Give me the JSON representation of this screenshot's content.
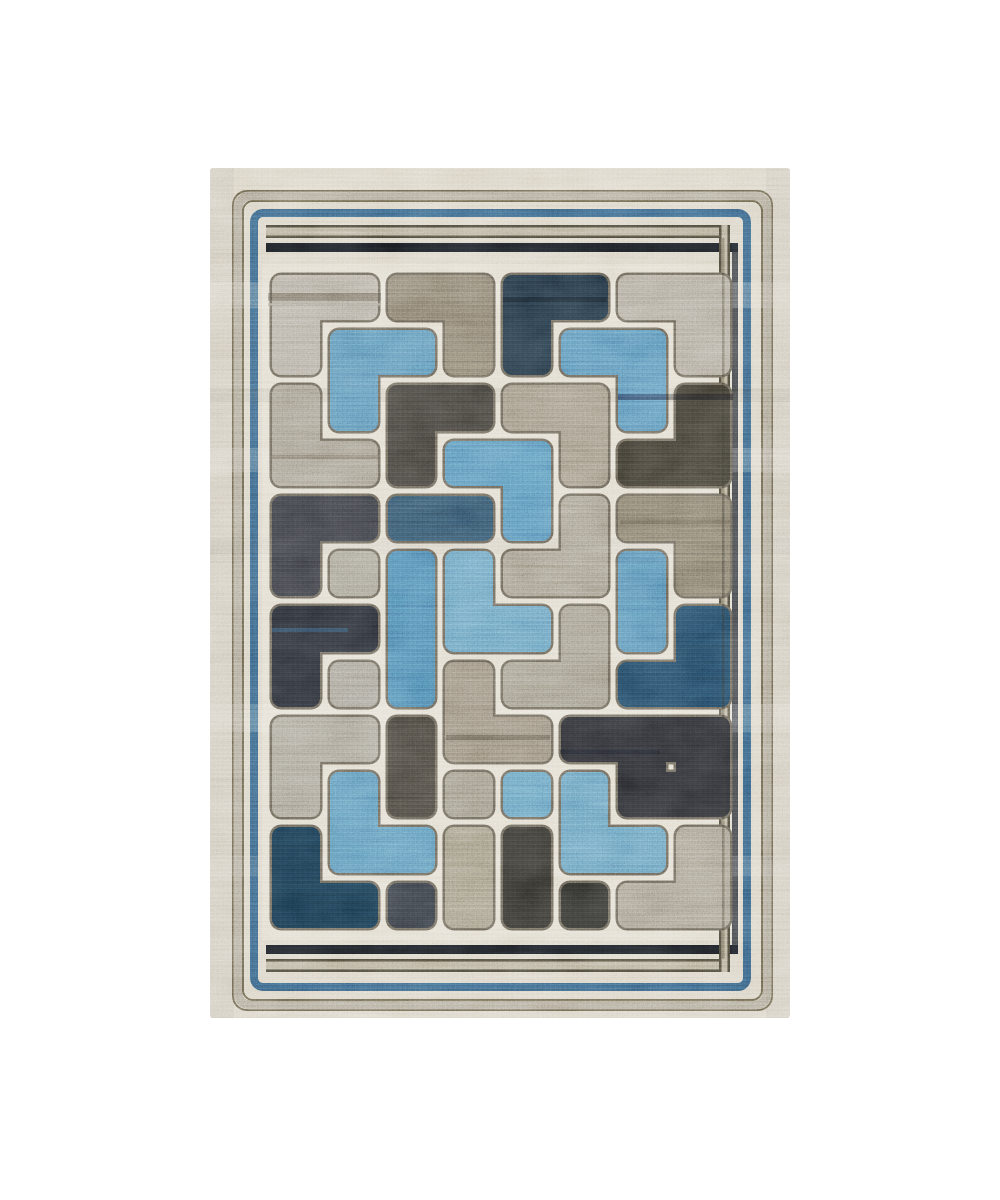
{
  "scene": {
    "width": 1000,
    "height": 1200,
    "background": "#ffffff"
  },
  "rug": {
    "x": 210,
    "y": 168,
    "width": 580,
    "height": 850,
    "base_color": "#cfc7b5",
    "field_bg": {
      "x": 262,
      "y": 264,
      "width": 478,
      "height": 676,
      "color": "#d8d1c0"
    },
    "frame_rects": [
      {
        "x": 233,
        "y": 191,
        "w": 539,
        "h": 819,
        "r": 14,
        "stroke": "#57513f",
        "sw": 2
      },
      {
        "x": 238,
        "y": 196,
        "w": 529,
        "h": 809,
        "r": 12,
        "stroke": "#9a917e",
        "sw": 9
      },
      {
        "x": 243,
        "y": 201,
        "w": 519,
        "h": 799,
        "r": 10,
        "stroke": "#57513f",
        "sw": 2
      },
      {
        "x": 254,
        "y": 213,
        "w": 493,
        "h": 774,
        "r": 9,
        "stroke": "#2e4f6a",
        "sw": 8
      }
    ],
    "stripes": [
      {
        "x": 266,
        "y": 225,
        "w": 464,
        "h": 13,
        "fill": "#a1977e",
        "opacity": 1
      },
      {
        "x": 266,
        "y": 225,
        "w": 464,
        "h": 2.5,
        "fill": "#3b382c",
        "opacity": 1
      },
      {
        "x": 266,
        "y": 235.5,
        "w": 464,
        "h": 2.5,
        "fill": "#3b382c",
        "opacity": 1
      },
      {
        "x": 266,
        "y": 243,
        "w": 472,
        "h": 9,
        "fill": "#15181c",
        "opacity": 1
      },
      {
        "x": 266,
        "y": 945,
        "w": 472,
        "h": 9,
        "fill": "#15181c",
        "opacity": 1
      },
      {
        "x": 266,
        "y": 959,
        "w": 464,
        "h": 13,
        "fill": "#a1977e",
        "opacity": 1
      },
      {
        "x": 266,
        "y": 959,
        "w": 464,
        "h": 2.5,
        "fill": "#3b382c",
        "opacity": 1
      },
      {
        "x": 266,
        "y": 969.5,
        "w": 464,
        "h": 2.5,
        "fill": "#3b382c",
        "opacity": 1
      },
      {
        "x": 719,
        "y": 225,
        "w": 11,
        "h": 747,
        "fill": "#a1977e",
        "opacity": 1
      },
      {
        "x": 719,
        "y": 225,
        "w": 2.5,
        "h": 747,
        "fill": "#3b382c",
        "opacity": 1
      },
      {
        "x": 727.5,
        "y": 225,
        "w": 2.5,
        "h": 747,
        "fill": "#3b382c",
        "opacity": 1
      },
      {
        "x": 732,
        "y": 243,
        "w": 6,
        "h": 711,
        "fill": "#1c2026",
        "opacity": 0.85
      }
    ],
    "over_lines": [
      {
        "x": 722,
        "y": 238,
        "w": 2.5,
        "h": 721,
        "fill": "#2a2a24",
        "opacity": 0.4
      }
    ],
    "weave_bands": [
      {
        "x": 210,
        "y": 282,
        "w": 580,
        "h": 26,
        "color": "#ffffff",
        "opacity": 0.13
      },
      {
        "x": 210,
        "y": 388,
        "w": 580,
        "h": 14,
        "color": "#3a362c",
        "opacity": 0.1
      },
      {
        "x": 210,
        "y": 448,
        "w": 580,
        "h": 24,
        "color": "#ffffff",
        "opacity": 0.12
      },
      {
        "x": 210,
        "y": 538,
        "w": 580,
        "h": 16,
        "color": "#3a362c",
        "opacity": 0.06
      },
      {
        "x": 210,
        "y": 704,
        "w": 580,
        "h": 28,
        "color": "#ffffff",
        "opacity": 0.11
      },
      {
        "x": 210,
        "y": 856,
        "w": 580,
        "h": 20,
        "color": "#ffffff",
        "opacity": 0.08
      },
      {
        "x": 210,
        "y": 168,
        "w": 24,
        "h": 850,
        "color": "#6b6557",
        "opacity": 0.1
      },
      {
        "x": 766,
        "y": 168,
        "w": 24,
        "h": 850,
        "color": "#6b6557",
        "opacity": 0.1
      }
    ],
    "field": {
      "col_bounds": [
        267,
        325,
        383,
        440,
        498,
        556,
        613,
        671,
        735
      ],
      "row_bounds": [
        270,
        325,
        380,
        436,
        491,
        546,
        601,
        657,
        712,
        767,
        822,
        878,
        933
      ],
      "gap_inset": 5,
      "corner_radius": 9,
      "outline_color": "#565147",
      "outline_width": 2.5
    },
    "palette": {
      "light1": "#9d9586",
      "light2": "#989080",
      "gray1": "#8b8376",
      "gray2": "#8d8779",
      "gray3": "#898173",
      "gray4": "#837d6f",
      "gray5": "#8b857a",
      "gray6": "#8f897b",
      "gray7": "#837d6f",
      "gray8": "#867f6d",
      "gray9": "#8b8274",
      "taupe1": "#6f675a",
      "taupe2": "#837a6b",
      "taupe3": "#6c6557",
      "taupe4": "#7d7466",
      "charcoal1": "#373430",
      "charcoal2": "#343129",
      "charcoal3": "#2f3136",
      "charcoal4": "#3a3731",
      "charcoal5": "#2d3137",
      "charcoal6": "#2b2a26",
      "charcoal7": "#282825",
      "black1": "#22252b",
      "black2": "#232428",
      "navy1": "#1d2b36",
      "navy2": "#2a4355",
      "navy3": "#1d3a50",
      "navy4": "#142c3d",
      "blue1": "#4c78a0",
      "blue2": "#4a77a2",
      "blue3": "#4877a3",
      "blue4": "#3f6d97",
      "blue5": "#5584ab",
      "blue6": "#5180a9",
      "blue7": "#5583aa",
      "blue8": "#4c7aa3",
      "blue9": "#47739c"
    },
    "pieces": [
      {
        "name": "light-L-top-left",
        "color": "light1",
        "cells": [
          [
            0,
            0
          ],
          [
            1,
            0
          ],
          [
            0,
            1
          ]
        ]
      },
      {
        "name": "blue-L-upper-left",
        "color": "blue1",
        "cells": [
          [
            1,
            1
          ],
          [
            2,
            1
          ],
          [
            1,
            2
          ]
        ]
      },
      {
        "name": "taupe-L-top-center",
        "color": "taupe1",
        "cells": [
          [
            2,
            0
          ],
          [
            3,
            0
          ],
          [
            3,
            1
          ]
        ]
      },
      {
        "name": "navy-L-top-center",
        "color": "navy1",
        "cells": [
          [
            4,
            0
          ],
          [
            5,
            0
          ],
          [
            4,
            1
          ]
        ]
      },
      {
        "name": "blue-L-upper-right",
        "color": "blue2",
        "cells": [
          [
            5,
            1
          ],
          [
            6,
            1
          ],
          [
            6,
            2
          ]
        ]
      },
      {
        "name": "light-L-top-right",
        "color": "light2",
        "cells": [
          [
            6,
            0
          ],
          [
            7,
            0
          ],
          [
            7,
            1
          ]
        ]
      },
      {
        "name": "gray-L-upper-left",
        "color": "gray1",
        "cells": [
          [
            0,
            2
          ],
          [
            0,
            3
          ],
          [
            1,
            3
          ]
        ]
      },
      {
        "name": "charcoal-L-upper-center",
        "color": "charcoal1",
        "cells": [
          [
            2,
            2
          ],
          [
            3,
            2
          ],
          [
            2,
            3
          ]
        ]
      },
      {
        "name": "taupe-L-upper-center",
        "color": "taupe2",
        "cells": [
          [
            4,
            2
          ],
          [
            5,
            2
          ],
          [
            5,
            3
          ]
        ]
      },
      {
        "name": "charcoal-L-upper-right",
        "color": "charcoal2",
        "cells": [
          [
            7,
            2
          ],
          [
            6,
            3
          ],
          [
            7,
            3
          ]
        ]
      },
      {
        "name": "blue-L-center",
        "color": "blue3",
        "cells": [
          [
            3,
            3
          ],
          [
            4,
            3
          ],
          [
            4,
            4
          ]
        ]
      },
      {
        "name": "navy-bar-center",
        "color": "navy2",
        "cells": [
          [
            2,
            4
          ],
          [
            3,
            4
          ]
        ]
      },
      {
        "name": "charcoal-L-mid-left",
        "color": "charcoal3",
        "cells": [
          [
            0,
            4
          ],
          [
            1,
            4
          ],
          [
            0,
            5
          ]
        ]
      },
      {
        "name": "gray-cell-mid-left",
        "color": "gray2",
        "cells": [
          [
            1,
            5
          ]
        ]
      },
      {
        "name": "blue-bar-center-left",
        "color": "blue4",
        "cells": [
          [
            2,
            5
          ],
          [
            2,
            6
          ],
          [
            2,
            7
          ]
        ]
      },
      {
        "name": "blue-L-center-mid",
        "color": "blue5",
        "cells": [
          [
            3,
            5
          ],
          [
            3,
            6
          ],
          [
            4,
            6
          ]
        ]
      },
      {
        "name": "black-L-lower-left",
        "color": "black1",
        "cells": [
          [
            0,
            6
          ],
          [
            1,
            6
          ],
          [
            0,
            7
          ]
        ]
      },
      {
        "name": "gray-L-center-mid",
        "color": "gray3",
        "cells": [
          [
            5,
            4
          ],
          [
            4,
            5
          ],
          [
            5,
            5
          ]
        ]
      },
      {
        "name": "taupe-L-mid-right",
        "color": "taupe3",
        "cells": [
          [
            6,
            4
          ],
          [
            7,
            4
          ],
          [
            7,
            5
          ]
        ]
      },
      {
        "name": "blue-bar-mid-right",
        "color": "blue9",
        "cells": [
          [
            6,
            5
          ],
          [
            6,
            6
          ]
        ]
      },
      {
        "name": "gray-L-center-lower",
        "color": "gray4",
        "cells": [
          [
            5,
            6
          ],
          [
            4,
            7
          ],
          [
            5,
            7
          ]
        ]
      },
      {
        "name": "navy-L-right",
        "color": "navy3",
        "cells": [
          [
            7,
            6
          ],
          [
            6,
            7
          ],
          [
            7,
            7
          ]
        ]
      },
      {
        "name": "gray-cell-lower-left",
        "color": "gray5",
        "cells": [
          [
            1,
            7
          ]
        ]
      },
      {
        "name": "taupe-L-bottom-center",
        "color": "taupe4",
        "cells": [
          [
            3,
            7
          ],
          [
            3,
            8
          ],
          [
            4,
            8
          ]
        ]
      },
      {
        "name": "gray-L-bottom-left",
        "color": "gray6",
        "cells": [
          [
            0,
            8
          ],
          [
            1,
            8
          ],
          [
            0,
            9
          ]
        ]
      },
      {
        "name": "charcoal-bar-bottom-left",
        "color": "charcoal4",
        "cells": [
          [
            2,
            8
          ],
          [
            2,
            9
          ]
        ]
      },
      {
        "name": "gray-cell-bottom-center",
        "color": "gray7",
        "cells": [
          [
            3,
            9
          ]
        ]
      },
      {
        "name": "blue-cell-bottom-center",
        "color": "blue6",
        "cells": [
          [
            4,
            9
          ]
        ]
      },
      {
        "name": "black-block-bottom-right",
        "color": "black2",
        "cells": [
          [
            5,
            8
          ],
          [
            6,
            8
          ],
          [
            7,
            8
          ],
          [
            6,
            9
          ],
          [
            7,
            9
          ]
        ]
      },
      {
        "name": "blue-L-bottom-right",
        "color": "blue7",
        "cells": [
          [
            5,
            9
          ],
          [
            5,
            10
          ],
          [
            6,
            10
          ]
        ]
      },
      {
        "name": "blue-L-bottom-left",
        "color": "blue8",
        "cells": [
          [
            1,
            9
          ],
          [
            1,
            10
          ],
          [
            2,
            10
          ]
        ]
      },
      {
        "name": "navy-L-bottom-left-corner",
        "color": "navy4",
        "cells": [
          [
            0,
            10
          ],
          [
            0,
            11
          ],
          [
            1,
            11
          ]
        ]
      },
      {
        "name": "charcoal-cell-bottom-left",
        "color": "charcoal5",
        "cells": [
          [
            2,
            11
          ]
        ]
      },
      {
        "name": "gray-bar-bottom-center",
        "color": "gray8",
        "cells": [
          [
            3,
            10
          ],
          [
            3,
            11
          ]
        ]
      },
      {
        "name": "charcoal-bar-bottom-center",
        "color": "charcoal6",
        "cells": [
          [
            4,
            10
          ],
          [
            4,
            11
          ]
        ]
      },
      {
        "name": "charcoal-cell-bottom-right",
        "color": "charcoal7",
        "cells": [
          [
            5,
            11
          ]
        ]
      },
      {
        "name": "gray-L-bottom-right-corner",
        "color": "gray9",
        "cells": [
          [
            7,
            10
          ],
          [
            6,
            11
          ],
          [
            7,
            11
          ]
        ]
      }
    ],
    "accent_streaks": [
      {
        "x": 268,
        "y": 293,
        "w": 113,
        "h": 8,
        "color": "#45413a",
        "opacity": 0.55
      },
      {
        "x": 268,
        "y": 303,
        "w": 113,
        "h": 3,
        "color": "#8d8678",
        "opacity": 0.65
      },
      {
        "x": 503,
        "y": 297,
        "w": 104,
        "h": 5,
        "color": "#0d131a",
        "opacity": 0.5
      },
      {
        "x": 618,
        "y": 394,
        "w": 115,
        "h": 6,
        "color": "#121419",
        "opacity": 0.5
      },
      {
        "x": 272,
        "y": 455,
        "w": 106,
        "h": 4,
        "color": "#3e3a33",
        "opacity": 0.35
      },
      {
        "x": 620,
        "y": 520,
        "w": 110,
        "h": 4,
        "color": "#423d33",
        "opacity": 0.35
      },
      {
        "x": 446,
        "y": 735,
        "w": 104,
        "h": 5,
        "color": "#26241f",
        "opacity": 0.35
      },
      {
        "x": 272,
        "y": 628,
        "w": 76,
        "h": 4,
        "color": "#2b5070",
        "opacity": 0.45
      },
      {
        "x": 560,
        "y": 750,
        "w": 100,
        "h": 4,
        "color": "#10151c",
        "opacity": 0.4
      }
    ],
    "noise_layers": [
      {
        "filter": "nSpeckle",
        "blend": "overlay",
        "opacity": 0.45
      },
      {
        "filter": "nStreak",
        "blend": "overlay",
        "opacity": 0.28
      },
      {
        "filter": "nBlotch",
        "blend": "soft-light",
        "opacity": 0.5
      }
    ]
  }
}
